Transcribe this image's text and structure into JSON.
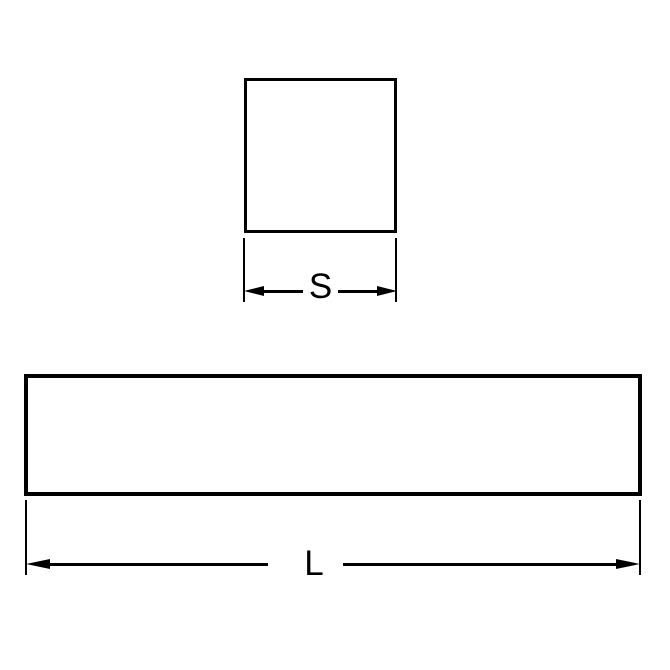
{
  "diagram": {
    "type": "engineering-dimension-drawing",
    "background": "#ffffff",
    "line_color": "#000000",
    "labels": {
      "square_side": "S",
      "bar_length": "L"
    }
  }
}
